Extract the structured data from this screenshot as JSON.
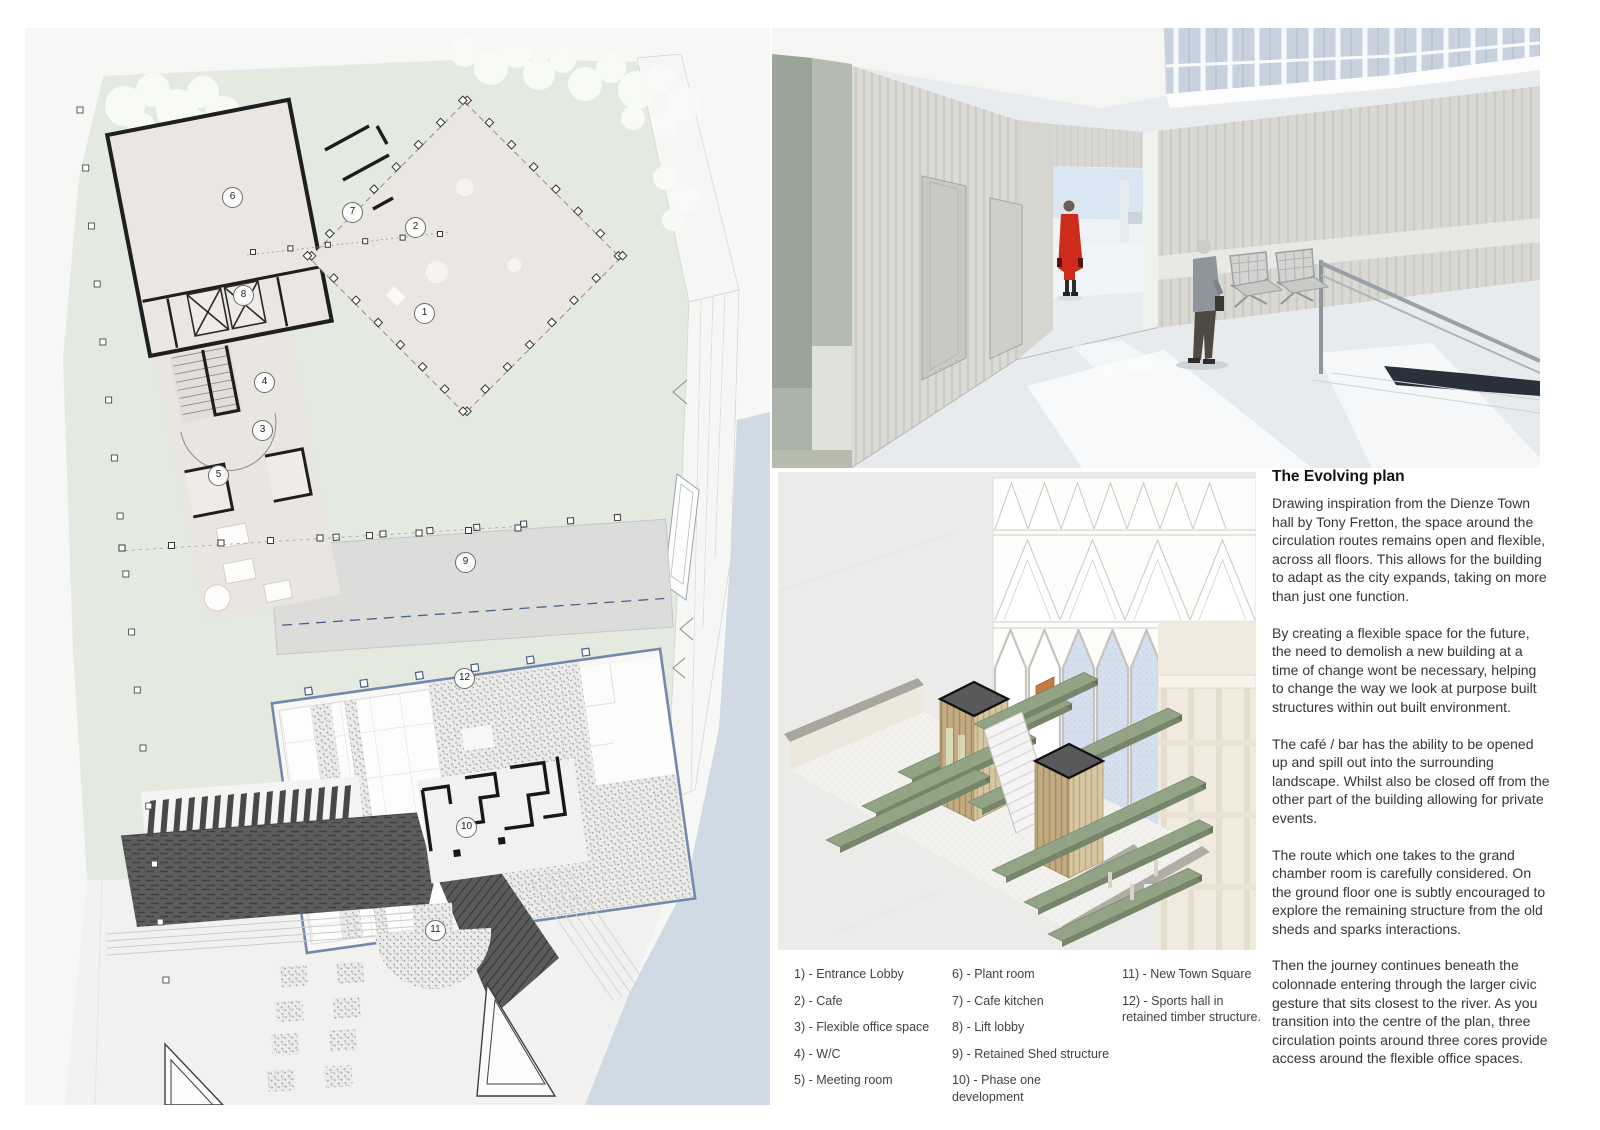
{
  "article": {
    "title": "The Evolving plan",
    "paragraphs": [
      "Drawing inspiration from the Dienze Town hall by Tony Fretton, the space around the circulation routes remains open and flexible, across all floors. This allows for the building to adapt as the city expands, taking on more than just one function.",
      "By creating a flexible space for the future, the need to demolish a new building at a time of change wont be necessary, helping to change the way we look at purpose built structures within out built environment.",
      "The café / bar has the ability to be opened up and spill out into the surrounding landscape. Whilst also be closed off from the other part of the building allowing for private events.",
      "The route which one takes to the grand chamber room is carefully considered. On the ground floor one is subtly encouraged to explore the remaining structure from the old sheds and sparks interactions.",
      "Then the journey continues beneath the colonnade entering through the larger civic gesture that sits closest to the river. As you transition into the centre of the plan, three circulation points around three cores provide access around the flexible office spaces."
    ]
  },
  "legend": {
    "columns": [
      {
        "items": [
          "1) - Entrance Lobby",
          "2) - Cafe",
          "3) - Flexible office space",
          "4) - W/C",
          "5) - Meeting room"
        ]
      },
      {
        "items": [
          "6) - Plant room",
          "7) - Cafe kitchen",
          "8) - Lift lobby",
          "9) - Retained Shed structure",
          "10) - Phase one development"
        ]
      },
      {
        "items": [
          "11) - New Town Square",
          "12) - Sports hall in retained timber structure."
        ]
      }
    ]
  },
  "plan": {
    "badges": [
      {
        "n": "1",
        "x": 399,
        "y": 285
      },
      {
        "n": "2",
        "x": 390,
        "y": 199
      },
      {
        "n": "3",
        "x": 237,
        "y": 402
      },
      {
        "n": "4",
        "x": 239,
        "y": 354
      },
      {
        "n": "5",
        "x": 193,
        "y": 447
      },
      {
        "n": "6",
        "x": 207,
        "y": 169
      },
      {
        "n": "7",
        "x": 327,
        "y": 184
      },
      {
        "n": "8",
        "x": 218,
        "y": 267
      },
      {
        "n": "9",
        "x": 440,
        "y": 534
      },
      {
        "n": "10",
        "x": 441,
        "y": 799
      },
      {
        "n": "11",
        "x": 410,
        "y": 902
      },
      {
        "n": "12",
        "x": 439,
        "y": 650
      }
    ]
  },
  "colors": {
    "landscape_green": "#e4eae0",
    "plan_floor": "#eae6e1",
    "wall_ink": "#1f1f1f",
    "retained_shed_grey": "#dcdcdb",
    "sports_hall_outline": "#7289ad",
    "dark_building": "#5d5d5d",
    "water_blue": "#cfdae4",
    "slab_green": "#93a385",
    "timber": "#c2ab82",
    "robe_red": "#ce2b1d",
    "concrete_green_grey": "#9aa498"
  }
}
